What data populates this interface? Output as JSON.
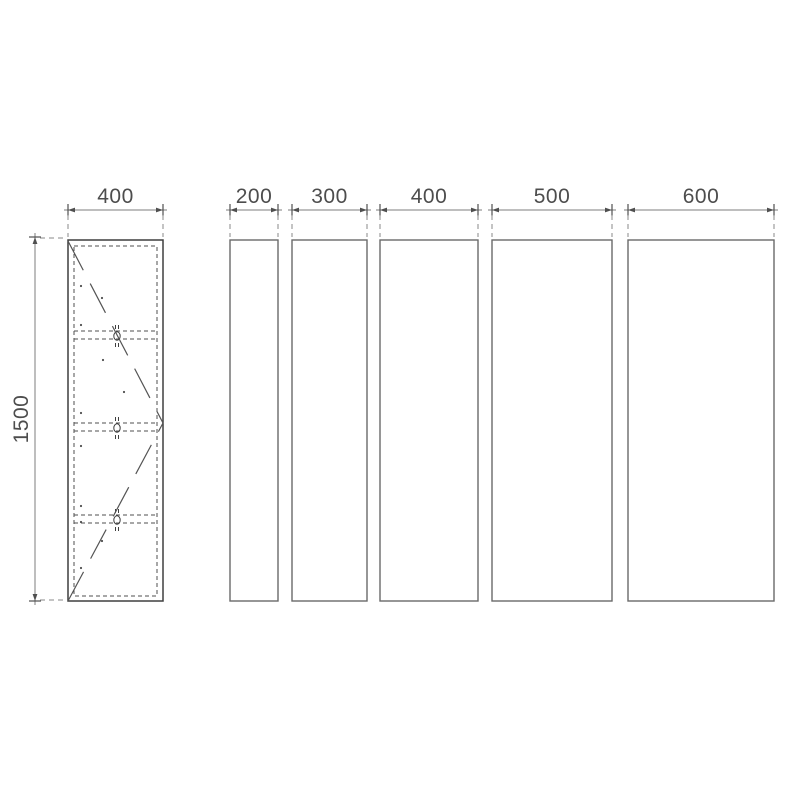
{
  "drawing": {
    "type": "cabinet width options technical drawing",
    "background_color": "#ffffff",
    "outline_color": "#3f3f3f",
    "panel_line_color": "#6a6a6a",
    "dimension_line_color": "#7c7c7c",
    "text_color": "#4d4d4d",
    "cabinet": {
      "description": "tall cabinet front elevation with three shelves and door swing lines",
      "width_label": "400",
      "height_label": "1500",
      "shelf_count": 3
    },
    "panels": [
      {
        "width_label": "200"
      },
      {
        "width_label": "300"
      },
      {
        "width_label": "400"
      },
      {
        "width_label": "500"
      },
      {
        "width_label": "600"
      }
    ]
  }
}
